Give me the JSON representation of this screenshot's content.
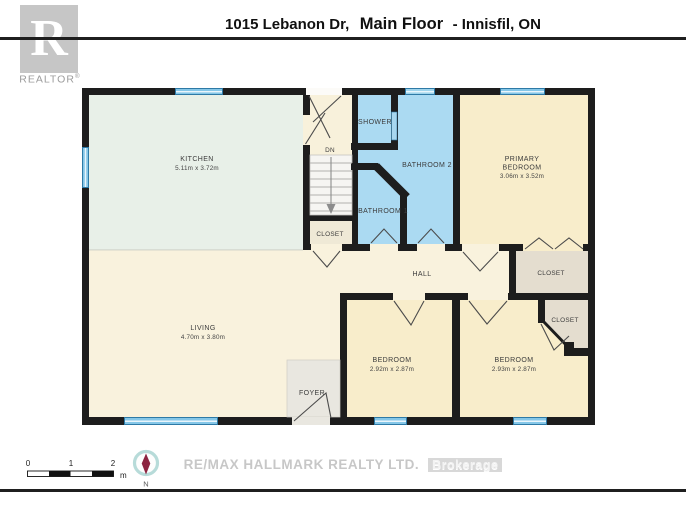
{
  "header": {
    "address": "1015 Lebanon Dr,",
    "floor_label": "Main Floor",
    "location": "- Innisfil, ON"
  },
  "realtor_logo": {
    "letter": "R",
    "wordmark": "REALTOR",
    "registered": "®"
  },
  "plan": {
    "kitchen": {
      "name": "KITCHEN",
      "dims": "5.11m x 3.72m"
    },
    "shower": {
      "name": "SHOWER"
    },
    "bathroom2": {
      "name": "BATHROOM 2"
    },
    "bathroom1": {
      "name": "BATHROOM 1"
    },
    "stairs": {
      "direction_label": "DN"
    },
    "stairs_closet": {
      "name": "CLOSET"
    },
    "primary_bedroom": {
      "name_line1": "PRIMARY",
      "name_line2": "BEDROOM",
      "dims": "3.06m x 3.52m"
    },
    "hall": {
      "name": "HALL"
    },
    "primary_closet": {
      "name": "CLOSET"
    },
    "bedroom_right_closet": {
      "name": "CLOSET"
    },
    "living": {
      "name": "LIVING",
      "dims": "4.70m x 3.80m"
    },
    "foyer": {
      "name": "FOYER"
    },
    "bedroom_left": {
      "name": "BEDROOM",
      "dims": "2.92m x 2.87m"
    },
    "bedroom_right": {
      "name": "BEDROOM",
      "dims": "2.93m x 2.87m"
    }
  },
  "scale_bar": {
    "ticks": [
      "0",
      "1",
      "2"
    ],
    "unit": "m"
  },
  "compass": {
    "north_label": "N"
  },
  "footer": {
    "brokerage": "RE/MAX HALLMARK REALTY LTD.",
    "brokerage_type": "Brokerage"
  },
  "colors": {
    "wall": "#1d1d1d",
    "kitchen_floor": "#e8f0e8",
    "bath_floor": "#abdaf2",
    "bedroom_floor": "#f8edcb",
    "hall_floor": "#f9f2dd",
    "closet_floor": "#e4ddcf",
    "foyer_floor": "#e9e7e0",
    "window_blue": "#85c7e8",
    "compass_needle": "#8c2340"
  }
}
